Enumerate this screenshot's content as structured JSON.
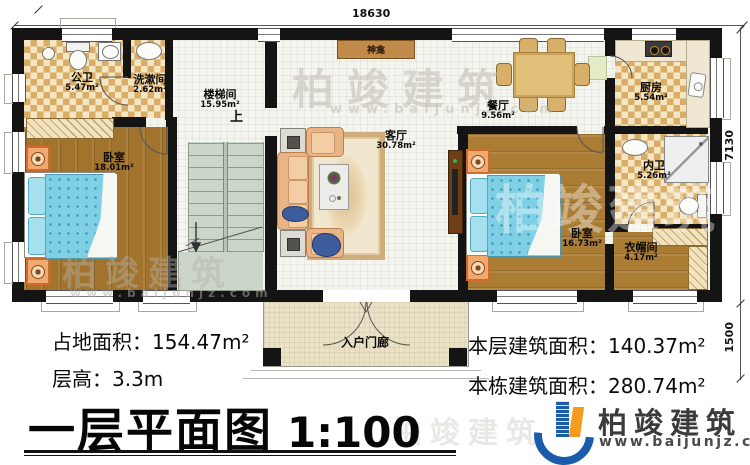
{
  "dimensions": {
    "width_top": "18630",
    "depth_main": "7130",
    "depth_porch": "1500"
  },
  "rooms": {
    "public_bath": {
      "name": "公卫",
      "area": "5.47m²"
    },
    "washroom": {
      "name": "洗漱间",
      "area": "2.62m²"
    },
    "stairwell": {
      "name": "楼梯间",
      "area": "15.95m²",
      "up_label": "上"
    },
    "shrine": {
      "name": "神龛"
    },
    "living": {
      "name": "客厅",
      "area": "30.78m²"
    },
    "dining": {
      "name": "餐厅",
      "area": "9.56m²"
    },
    "kitchen": {
      "name": "厨房",
      "area": "5.54m²"
    },
    "inner_bath": {
      "name": "内卫",
      "area": "5.26m²"
    },
    "bedroom_left": {
      "name": "卧室",
      "area": "18.01m²"
    },
    "bedroom_right": {
      "name": "卧室",
      "area": "16.73m²"
    },
    "cloakroom": {
      "name": "衣帽间",
      "area": "4.17m²"
    },
    "porch": {
      "name": "入户门廊"
    }
  },
  "stats": {
    "left": [
      {
        "label": "占地面积：",
        "value": "154.47m²"
      },
      {
        "label": "层高：",
        "value": "3.3m"
      }
    ],
    "right": [
      {
        "label": "本层建筑面积：",
        "value": "140.37m²"
      },
      {
        "label": "本栋建筑面积：",
        "value": "280.74m²"
      }
    ]
  },
  "title": {
    "text": "一层平面图",
    "scale": "1:100"
  },
  "brand": {
    "name": "柏竣建筑",
    "url": "www.baijunjz.com"
  },
  "watermark": {
    "text": "柏竣建筑",
    "url": "www.baijunjz.com"
  }
}
